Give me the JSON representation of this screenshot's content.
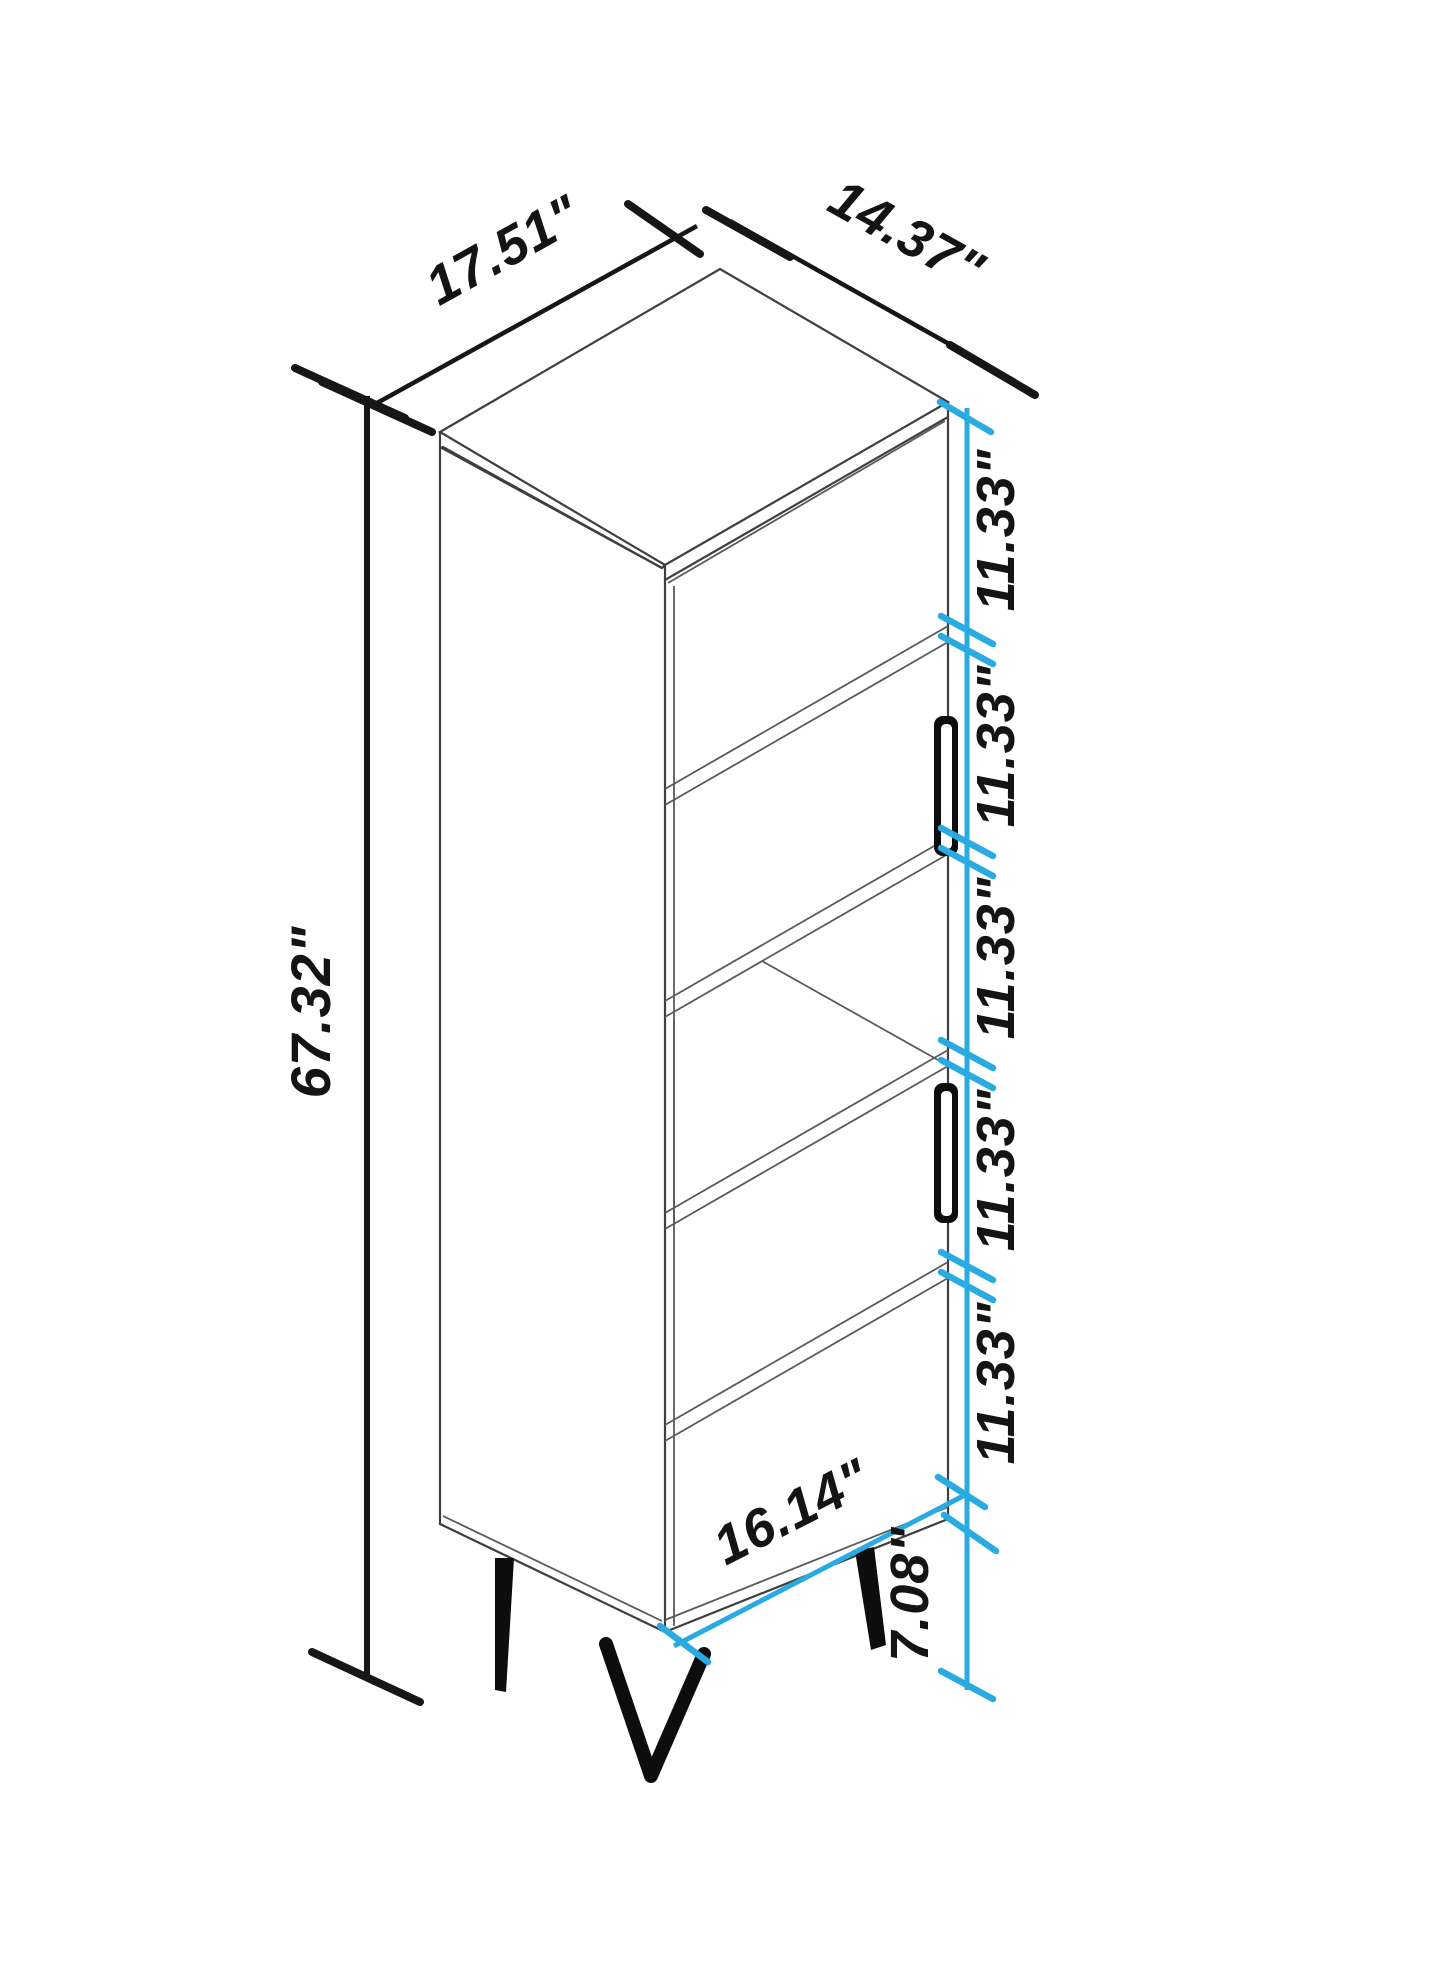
{
  "diagram": {
    "kind": "furniture dimension drawing",
    "subject": "tall narrow bookcase cabinet with two doors, open middle shelf and hairpin legs, isometric view",
    "units": "inches",
    "accent_color": "#29abe2",
    "line_color": "#161616",
    "labels": {
      "width": "17.51\"",
      "depth": "14.37\"",
      "height": "67.32\"",
      "sections": [
        "11.33\"",
        "11.33\"",
        "11.33\"",
        "11.33\"",
        "11.33\""
      ],
      "shelf_width": "16.14\"",
      "leg_height": "7.08\""
    }
  }
}
